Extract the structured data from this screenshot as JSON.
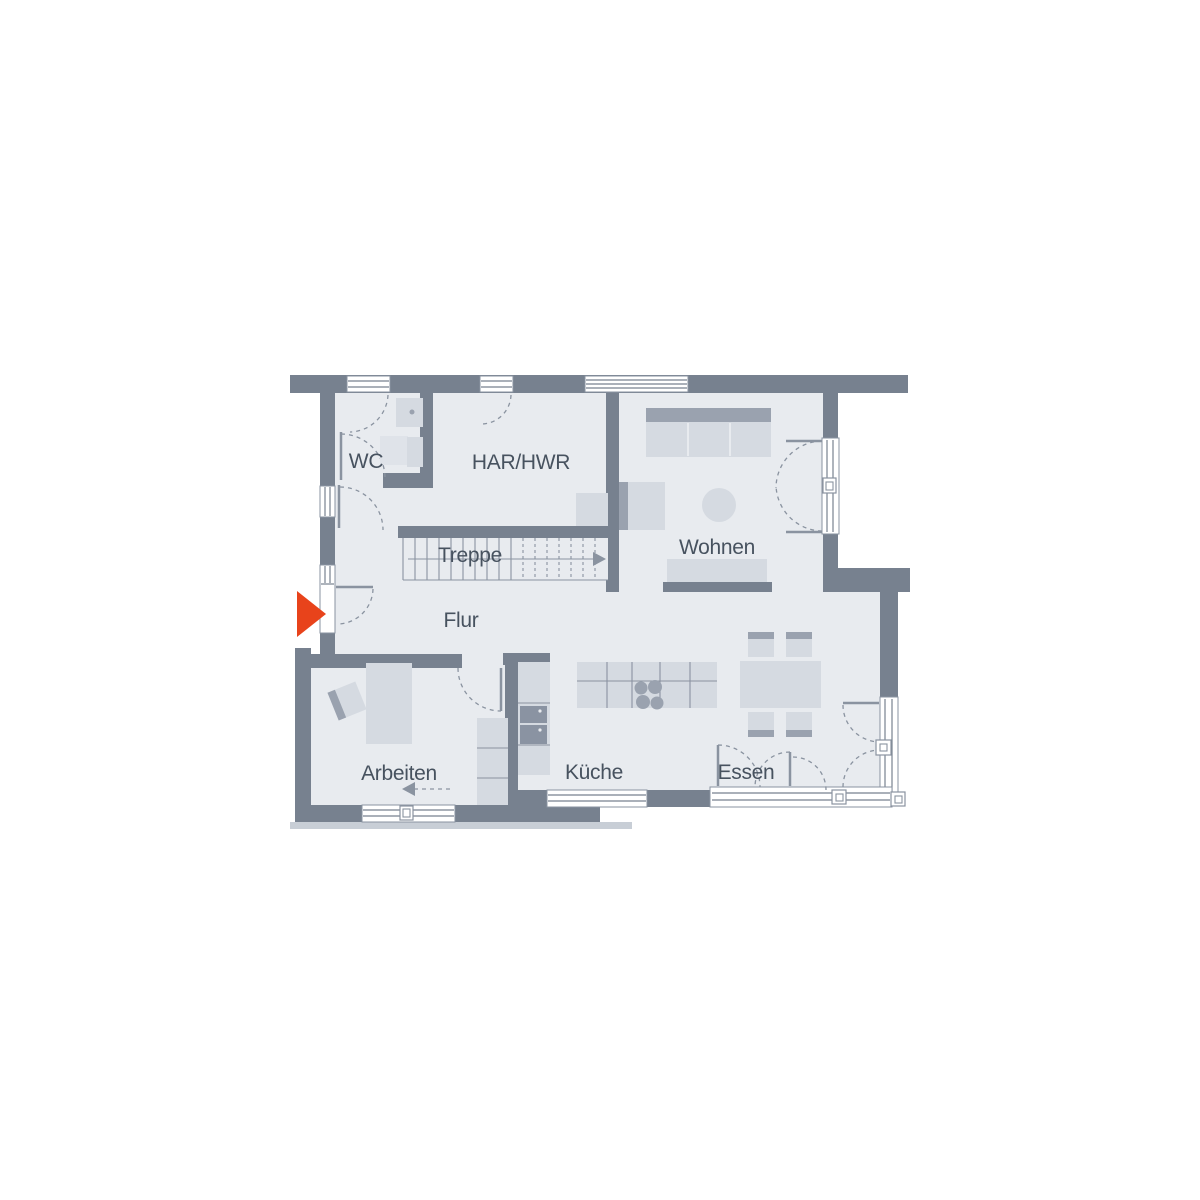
{
  "plan_type": "floorplan",
  "rooms": {
    "wc": "WC",
    "har_hwr": "HAR/HWR",
    "treppe": "Treppe",
    "wohnen": "Wohnen",
    "flur": "Flur",
    "arbeiten": "Arbeiten",
    "kueche": "Küche",
    "essen": "Essen"
  },
  "icons": {
    "entrance": "entrance-arrow-icon"
  },
  "colors": {
    "wall": "#77818F",
    "floor": "#E8EBEF",
    "furniture": "#D5DAE1",
    "furniture_light": "#DFE3E9",
    "furniture_dark": "#9AA2AF",
    "appliance": "#8A93A2",
    "line": "#8A93A0",
    "shadow": "#C8CED6",
    "accent": "#E8431B",
    "text": "#47525F"
  }
}
